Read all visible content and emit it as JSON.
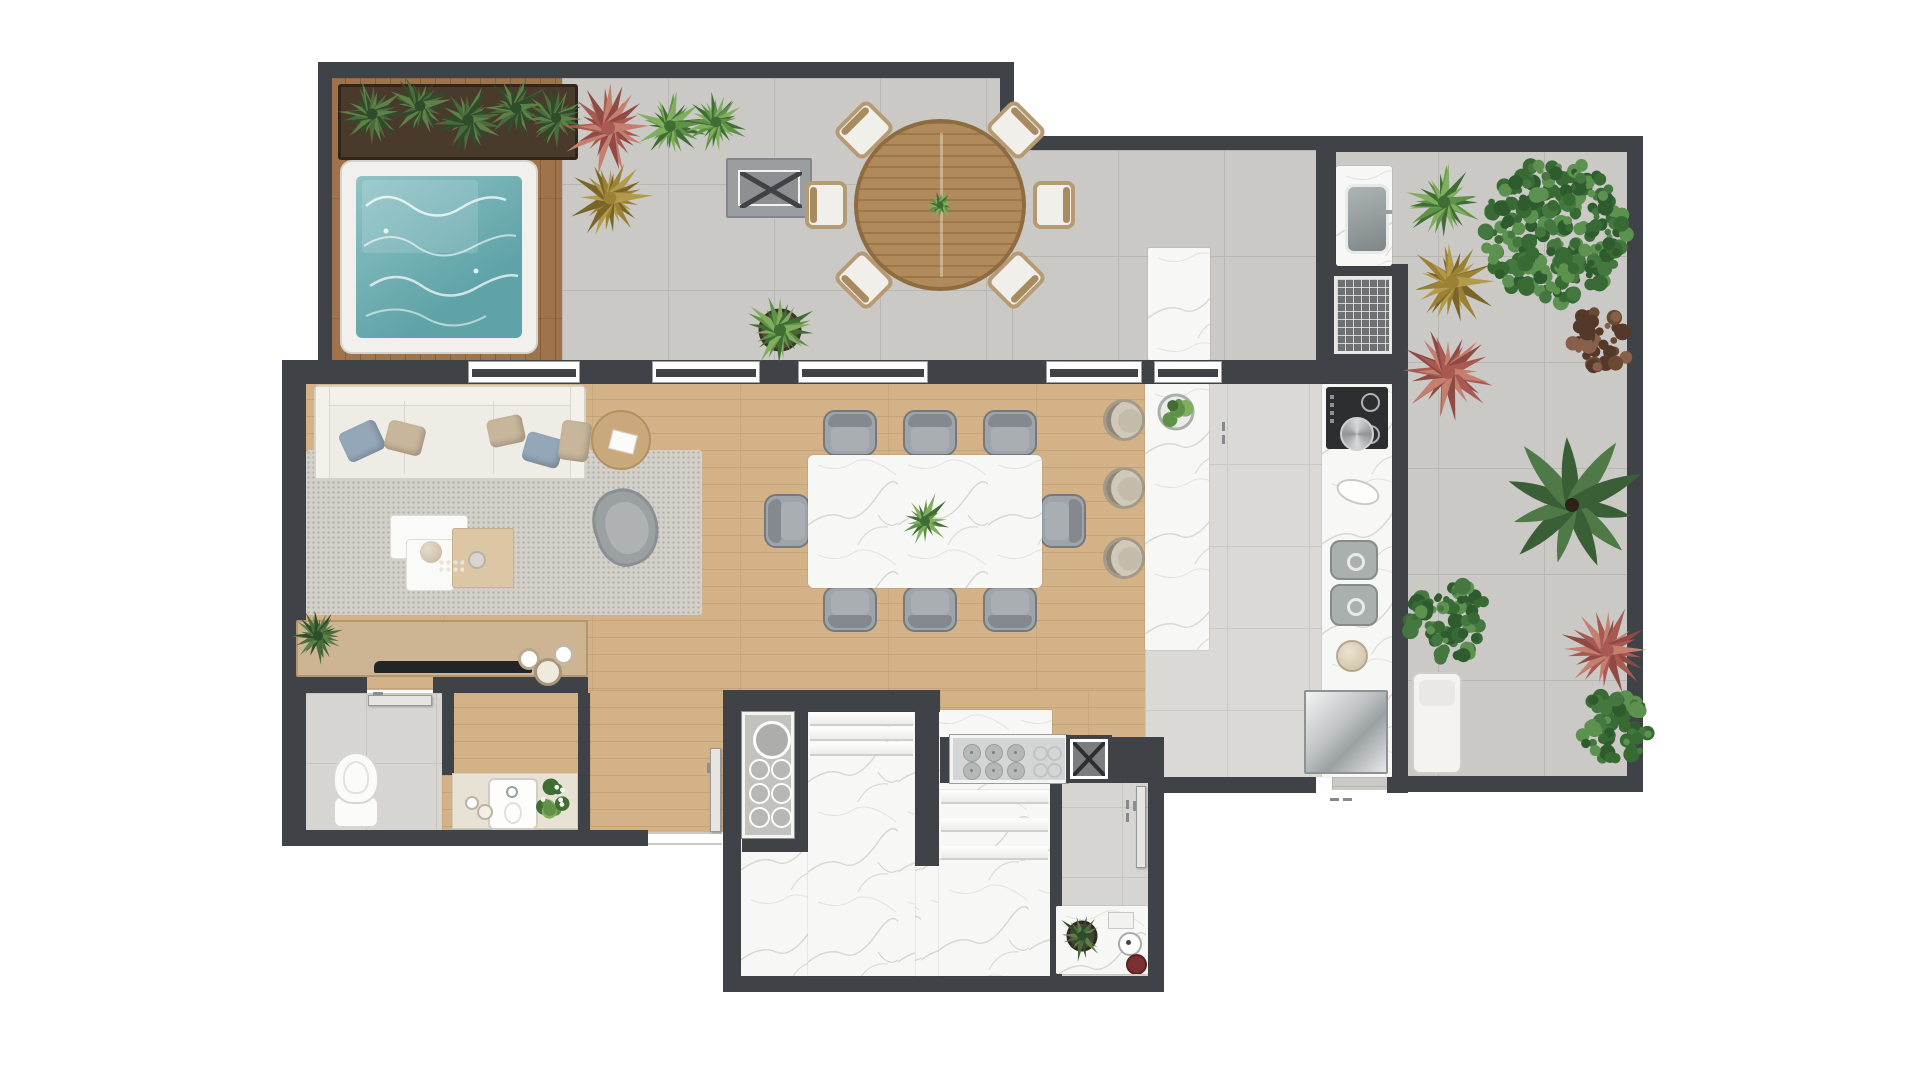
{
  "meta": {
    "title": "Penthouse apartment floor plan — top-down architectural render",
    "visible_text": "none"
  },
  "palette": {
    "wall": "#3f4347",
    "terrace_tile": "#cac9c5",
    "kitchen_tile": "#dad9d5",
    "wood": "#d4b287",
    "deck": "#a0744b",
    "marble": "#f7f7f5",
    "water": "#74b1b5",
    "rug": "#d3d0ca",
    "sofa": "#efece6",
    "gray_furniture": "#9ea4a9",
    "green": "#4c7a3c",
    "red_plant": "#a85a52",
    "stainless": "#b9bdbe"
  },
  "rooms": [
    {
      "name": "spa-deck-terrace"
    },
    {
      "name": "gourmet-terrace-dining"
    },
    {
      "name": "barbecue-area"
    },
    {
      "name": "living-room"
    },
    {
      "name": "dining-room"
    },
    {
      "name": "kitchen"
    },
    {
      "name": "right-terrace-garden"
    },
    {
      "name": "powder-room"
    },
    {
      "name": "vanity-hall"
    },
    {
      "name": "entry-hall"
    },
    {
      "name": "staircase-hall"
    },
    {
      "name": "service-area"
    }
  ],
  "floors": [
    {
      "t": "woodv",
      "n": "spa-deck-floor",
      "x": 330,
      "y": 78,
      "w": 232,
      "h": 284
    },
    {
      "t": "tile",
      "n": "terrace-floor-main",
      "x": 562,
      "y": 78,
      "w": 450,
      "h": 284
    },
    {
      "t": "tile",
      "n": "terrace-floor-gourmet",
      "x": 1012,
      "y": 150,
      "w": 320,
      "h": 212
    },
    {
      "t": "tile",
      "n": "terrace-floor-right",
      "x": 1332,
      "y": 150,
      "w": 298,
      "h": 640
    },
    {
      "t": "wood",
      "n": "living-dining-floor",
      "x": 296,
      "y": 382,
      "w": 849,
      "h": 308
    },
    {
      "t": "wood",
      "n": "hall-floor",
      "x": 442,
      "y": 690,
      "w": 281,
      "h": 142
    },
    {
      "t": "wood",
      "n": "hall-floor-east",
      "x": 940,
      "y": 690,
      "w": 224,
      "h": 47
    },
    {
      "t": "ktile",
      "n": "kitchen-floor",
      "x": 1145,
      "y": 382,
      "w": 247,
      "h": 395
    },
    {
      "t": "ptile",
      "n": "powder-room-floor",
      "x": 296,
      "y": 693,
      "w": 146,
      "h": 139
    },
    {
      "t": "marblef",
      "n": "stair-hall-floor",
      "x": 741,
      "y": 710,
      "w": 311,
      "h": 266
    },
    {
      "t": "ptile",
      "n": "service-room-floor",
      "x": 1052,
      "y": 737,
      "w": 96,
      "h": 239
    },
    {
      "t": "rug",
      "n": "living-room-rug",
      "x": 306,
      "y": 450,
      "w": 396,
      "h": 165
    }
  ],
  "walls": [
    [
      318,
      62,
      696,
      16
    ],
    [
      318,
      62,
      14,
      300
    ],
    [
      1000,
      62,
      14,
      88
    ],
    [
      1000,
      136,
      334,
      14
    ],
    [
      1332,
      136,
      311,
      16
    ],
    [
      1627,
      136,
      16,
      656
    ],
    [
      1392,
      776,
      251,
      16
    ],
    [
      1392,
      362,
      16,
      430
    ],
    [
      282,
      360,
      1126,
      24
    ],
    [
      282,
      360,
      24,
      486
    ],
    [
      282,
      830,
      366,
      16
    ],
    [
      282,
      677,
      85,
      16
    ],
    [
      433,
      677,
      155,
      16
    ],
    [
      442,
      693,
      12,
      82
    ],
    [
      578,
      693,
      12,
      139
    ],
    [
      741,
      690,
      67,
      22
    ],
    [
      808,
      690,
      132,
      22
    ],
    [
      794,
      712,
      14,
      126
    ],
    [
      742,
      838,
      66,
      14
    ],
    [
      723,
      690,
      18,
      302
    ],
    [
      723,
      976,
      441,
      16
    ],
    [
      915,
      712,
      24,
      154
    ],
    [
      940,
      737,
      12,
      46
    ],
    [
      1112,
      737,
      52,
      46
    ],
    [
      1050,
      783,
      12,
      193
    ],
    [
      1148,
      737,
      16,
      255
    ],
    [
      1164,
      777,
      152,
      16
    ],
    [
      1387,
      777,
      21,
      16
    ],
    [
      1316,
      150,
      20,
      216
    ],
    [
      1316,
      264,
      92,
      102
    ]
  ],
  "windows": [
    {
      "n": "living-terrace-window-1",
      "x": 468,
      "w": 112
    },
    {
      "n": "living-terrace-window-2",
      "x": 652,
      "w": 108
    },
    {
      "n": "dining-terrace-window",
      "x": 798,
      "w": 130
    },
    {
      "n": "dining-terrace-window-2",
      "x": 1046,
      "w": 96
    },
    {
      "n": "kitchen-terrace-window",
      "x": 1154,
      "w": 68
    }
  ],
  "furniture": [
    {
      "t": "planter",
      "n": "deck-planter-box",
      "x": 338,
      "y": 84,
      "w": 240,
      "h": 76
    },
    {
      "t": "pool",
      "n": "jacuzzi-spa-pool",
      "x": 340,
      "y": 160,
      "w": 198,
      "h": 194
    },
    {
      "t": "bench",
      "n": "terrace-bench",
      "x": 726,
      "y": 158,
      "w": 86,
      "h": 60
    },
    {
      "t": "ochair",
      "n": "outdoor-dining-chair",
      "cx": 864,
      "cy": 130,
      "deg": -45
    },
    {
      "t": "ochair",
      "n": "outdoor-dining-chair",
      "cx": 1016,
      "cy": 130,
      "deg": 45
    },
    {
      "t": "ochair",
      "n": "outdoor-dining-chair",
      "cx": 826,
      "cy": 205,
      "deg": -90
    },
    {
      "t": "ochair",
      "n": "outdoor-dining-chair",
      "cx": 1054,
      "cy": 205,
      "deg": 90
    },
    {
      "t": "ochair",
      "n": "outdoor-dining-chair",
      "cx": 864,
      "cy": 280,
      "deg": -135
    },
    {
      "t": "ochair",
      "n": "outdoor-dining-chair",
      "cx": 1016,
      "cy": 280,
      "deg": 135
    },
    {
      "t": "otable",
      "n": "outdoor-round-dining-table",
      "cx": 940,
      "cy": 205,
      "r": 86
    },
    {
      "t": "marble",
      "n": "terrace-marble-counter",
      "x": 1148,
      "y": 248,
      "w": 62,
      "h": 112
    },
    {
      "t": "sinkc",
      "n": "barbecue-sink-counter",
      "x": 1336,
      "y": 166,
      "w": 56,
      "h": 100
    },
    {
      "t": "grill",
      "n": "barbecue-grill",
      "x": 1334,
      "y": 276,
      "w": 58,
      "h": 78
    },
    {
      "t": "sofa",
      "n": "living-room-sofa",
      "x": 314,
      "y": 385,
      "w": 272,
      "h": 95
    },
    {
      "t": "sidetable",
      "n": "side-table",
      "cx": 621,
      "cy": 440,
      "r": 30
    },
    {
      "t": "armchair",
      "n": "living-armchair",
      "cx": 626,
      "cy": 527
    },
    {
      "t": "coffee",
      "n": "coffee-table-set",
      "x": 390,
      "y": 515
    },
    {
      "t": "console",
      "n": "tv-console",
      "x": 296,
      "y": 620,
      "w": 292,
      "h": 57
    },
    {
      "t": "gchair",
      "n": "dining-chair",
      "cx": 850,
      "cy": 433,
      "deg": 0
    },
    {
      "t": "gchair",
      "n": "dining-chair",
      "cx": 930,
      "cy": 433,
      "deg": 0
    },
    {
      "t": "gchair",
      "n": "dining-chair",
      "cx": 1010,
      "cy": 433,
      "deg": 0
    },
    {
      "t": "gchair",
      "n": "dining-chair",
      "cx": 850,
      "cy": 609,
      "deg": 180
    },
    {
      "t": "gchair",
      "n": "dining-chair",
      "cx": 930,
      "cy": 609,
      "deg": 180
    },
    {
      "t": "gchair",
      "n": "dining-chair",
      "cx": 1010,
      "cy": 609,
      "deg": 180
    },
    {
      "t": "gchair",
      "n": "dining-chair",
      "cx": 787,
      "cy": 521,
      "deg": -90
    },
    {
      "t": "gchair",
      "n": "dining-chair",
      "cx": 1063,
      "cy": 521,
      "deg": 90
    },
    {
      "t": "marble",
      "n": "dining-table-marble",
      "x": 808,
      "y": 455,
      "w": 234,
      "h": 133,
      "rx": 6
    },
    {
      "t": "stool",
      "n": "island-bar-stool",
      "cx": 1124,
      "cy": 420
    },
    {
      "t": "stool",
      "n": "island-bar-stool",
      "cx": 1124,
      "cy": 488
    },
    {
      "t": "stool",
      "n": "island-bar-stool",
      "cx": 1124,
      "cy": 558
    },
    {
      "t": "marble",
      "n": "kitchen-island",
      "x": 1145,
      "y": 384,
      "w": 64,
      "h": 266
    },
    {
      "t": "marble",
      "n": "kitchen-counter",
      "x": 1322,
      "y": 384,
      "w": 70,
      "h": 393
    },
    {
      "t": "cooktop",
      "n": "kitchen-cooktop",
      "x": 1326,
      "y": 387,
      "w": 62,
      "h": 62
    },
    {
      "t": "oval",
      "n": "counter-dish",
      "cx": 1358,
      "cy": 492
    },
    {
      "t": "dsink",
      "n": "kitchen-double-sink",
      "x": 1330,
      "y": 540,
      "w": 48,
      "h": 86
    },
    {
      "t": "bowl",
      "n": "counter-bowl",
      "cx": 1352,
      "cy": 656,
      "r": 16
    },
    {
      "t": "fridge",
      "n": "refrigerator",
      "x": 1304,
      "y": 690,
      "w": 84,
      "h": 84
    },
    {
      "t": "toilet",
      "n": "powder-room-toilet",
      "cx": 356,
      "cy": 790
    },
    {
      "t": "door",
      "n": "powder-room-door",
      "x": 368,
      "y": 695,
      "w": 64,
      "h": 11
    },
    {
      "t": "vanity",
      "n": "vanity-sink-counter",
      "x": 452,
      "y": 773,
      "w": 126,
      "h": 56
    },
    {
      "t": "thresh",
      "n": "entry-threshold",
      "x": 648,
      "y": 832,
      "w": 74,
      "h": 13
    },
    {
      "t": "door",
      "n": "entry-door",
      "x": 710,
      "y": 748,
      "w": 11,
      "h": 84
    },
    {
      "t": "rack",
      "n": "towel-rack-shelf",
      "x": 742,
      "y": 712,
      "w": 52,
      "h": 126
    },
    {
      "t": "stairs",
      "n": "staircase-upper-flight",
      "x": 808,
      "y": 712,
      "w": 107,
      "h": 264,
      "treads": [
        712,
        727,
        742
      ]
    },
    {
      "t": "stairs",
      "n": "staircase-lower-flight",
      "x": 939,
      "y": 790,
      "w": 111,
      "h": 186,
      "treads": [
        790,
        818,
        846
      ]
    },
    {
      "t": "panel",
      "n": "service-cooktop-panel",
      "x": 950,
      "y": 735,
      "w": 118,
      "h": 48
    },
    {
      "t": "xbox",
      "n": "service-shaft",
      "x": 1066,
      "y": 735,
      "w": 46,
      "h": 48
    },
    {
      "t": "door",
      "n": "service-door",
      "x": 1136,
      "y": 786,
      "w": 10,
      "h": 82
    },
    {
      "t": "scounter",
      "n": "service-counter",
      "x": 1056,
      "y": 906,
      "w": 92,
      "h": 68
    },
    {
      "t": "lounger",
      "n": "terrace-lounger",
      "x": 1412,
      "y": 672,
      "w": 50,
      "h": 102
    },
    {
      "t": "handle",
      "n": "door-handle",
      "x": 1222,
      "y": 422,
      "dir": "v"
    },
    {
      "t": "handle",
      "n": "door-handle",
      "x": 1330,
      "y": 798,
      "dir": "h"
    },
    {
      "t": "handle",
      "n": "door-handle",
      "x": 1126,
      "y": 800,
      "dir": "v"
    }
  ],
  "plants": [
    {
      "k": "fern",
      "n": "planter-ferns",
      "cx": 372,
      "cy": 114,
      "r": 36
    },
    {
      "k": "fern",
      "n": "planter-ferns",
      "cx": 420,
      "cy": 106,
      "r": 34
    },
    {
      "k": "fern",
      "n": "planter-ferns",
      "cx": 468,
      "cy": 120,
      "r": 36
    },
    {
      "k": "fern",
      "n": "planter-ferns",
      "cx": 516,
      "cy": 108,
      "r": 34
    },
    {
      "k": "fern",
      "n": "planter-ferns",
      "cx": 556,
      "cy": 118,
      "r": 32
    },
    {
      "k": "spiky",
      "n": "red-bromeliad-plant",
      "cx": 608,
      "cy": 128,
      "r": 50,
      "c": "red"
    },
    {
      "k": "spiky",
      "n": "yellow-spiky-plant",
      "cx": 610,
      "cy": 198,
      "r": 44,
      "c": "yellow"
    },
    {
      "k": "spiky",
      "n": "green-spiky-plant",
      "cx": 670,
      "cy": 126,
      "r": 38,
      "c": "green"
    },
    {
      "k": "spiky",
      "n": "green-spiky-plant",
      "cx": 716,
      "cy": 122,
      "r": 34,
      "c": "green"
    },
    {
      "k": "pot",
      "n": "potted-agave",
      "cx": 780,
      "cy": 330,
      "r": 40
    },
    {
      "k": "cplant",
      "n": "table-centerpiece-plant",
      "cx": 940,
      "cy": 205,
      "r": 16
    },
    {
      "k": "spiky",
      "n": "green-spiky-plant",
      "cx": 1444,
      "cy": 202,
      "r": 42,
      "c": "green"
    },
    {
      "k": "tree",
      "n": "terrace-tree",
      "cx": 1556,
      "cy": 232,
      "r": 78
    },
    {
      "k": "spiky",
      "n": "yellow-spiky-plant",
      "cx": 1452,
      "cy": 282,
      "r": 48,
      "c": "yellow"
    },
    {
      "k": "spiky",
      "n": "red-bromeliad-plant",
      "cx": 1448,
      "cy": 372,
      "r": 50,
      "c": "red"
    },
    {
      "k": "bush",
      "n": "brown-shrub",
      "cx": 1601,
      "cy": 340,
      "r": 34,
      "c": "brown"
    },
    {
      "k": "palm",
      "n": "palm-tree",
      "cx": 1572,
      "cy": 505,
      "r": 75
    },
    {
      "k": "tree",
      "n": "boxwood-ball",
      "cx": 1449,
      "cy": 622,
      "r": 44
    },
    {
      "k": "spiky",
      "n": "red-bromeliad-plant",
      "cx": 1607,
      "cy": 650,
      "r": 48,
      "c": "red"
    },
    {
      "k": "tree",
      "n": "green-shrub",
      "cx": 1616,
      "cy": 726,
      "r": 38
    },
    {
      "k": "fern",
      "n": "console-monstera",
      "cx": 318,
      "cy": 636,
      "r": 30
    },
    {
      "k": "flowers",
      "n": "vanity-flowers",
      "cx": 552,
      "cy": 800,
      "r": 16
    },
    {
      "k": "salad",
      "n": "island-salad-bowl",
      "cx": 1176,
      "cy": 412
    },
    {
      "k": "cplant",
      "n": "dining-centerpiece-plant",
      "cx": 925,
      "cy": 521,
      "r": 30
    },
    {
      "k": "potf",
      "n": "service-plant",
      "cx": 1082,
      "cy": 936,
      "r": 28
    }
  ],
  "sofa_pillows": [
    {
      "x": 26,
      "y": 38,
      "w": 40,
      "h": 32,
      "deg": -25,
      "c": "blue"
    },
    {
      "x": 70,
      "y": 36,
      "w": 38,
      "h": 30,
      "deg": 14,
      "c": "tan"
    },
    {
      "x": 172,
      "y": 30,
      "w": 36,
      "h": 28,
      "deg": -12,
      "c": "tan"
    },
    {
      "x": 208,
      "y": 48,
      "w": 38,
      "h": 30,
      "deg": 16,
      "c": "blue"
    },
    {
      "x": 244,
      "y": 34,
      "w": 30,
      "h": 40,
      "deg": 8,
      "c": "tan"
    }
  ]
}
